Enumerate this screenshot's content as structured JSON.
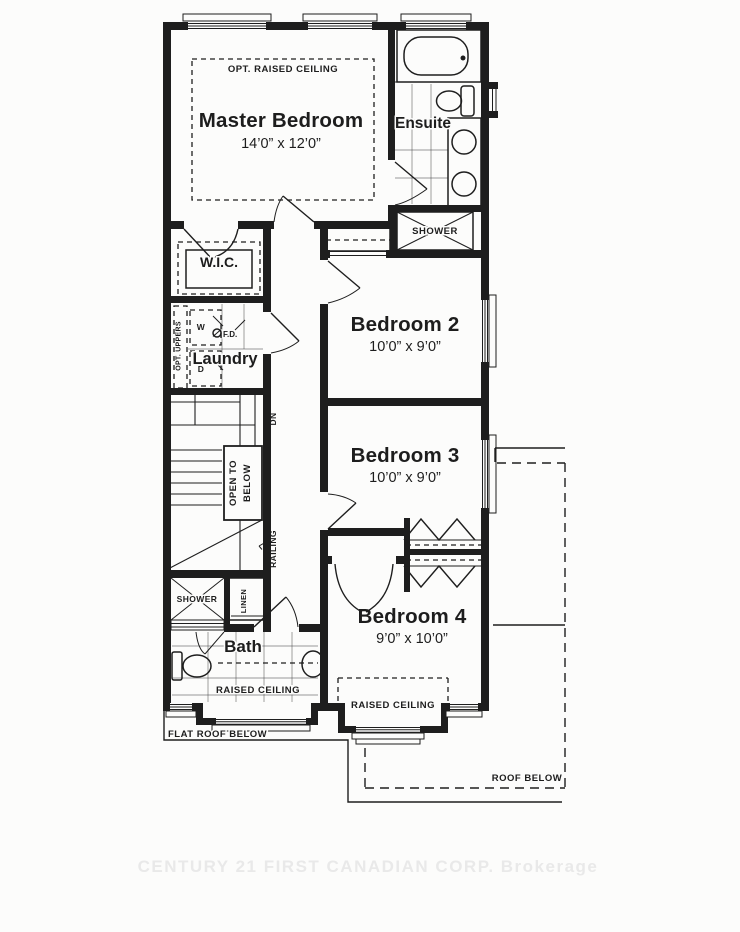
{
  "page": {
    "background": "#fcfcfb",
    "ink": "#1d1d1d",
    "watermark_color": "#e9e9e9"
  },
  "plan": {
    "master_bedroom": {
      "name": "Master Bedroom",
      "dims": "14’0” x 12’0”",
      "ceiling_note": "OPT. RAISED CEILING"
    },
    "ensuite": {
      "name": "Ensuite",
      "shower": "SHOWER"
    },
    "wic": {
      "name": "W.I.C."
    },
    "laundry": {
      "name": "Laundry",
      "washer": "W",
      "dryer": "D",
      "floor_drain": "F.D.",
      "uppers": "OPT. UPPERS"
    },
    "stairs": {
      "down": "DN",
      "open_to_below_1": "OPEN TO",
      "open_to_below_2": "BELOW",
      "railing": "RAILING"
    },
    "bedroom_2": {
      "name": "Bedroom 2",
      "dims": "10’0” x 9’0”"
    },
    "bedroom_3": {
      "name": "Bedroom 3",
      "dims": "10’0” x 9’0”"
    },
    "bedroom_4": {
      "name": "Bedroom 4",
      "dims": "9’0” x 10’0”",
      "raised_ceiling": "RAISED CEILING"
    },
    "bath": {
      "name": "Bath",
      "shower": "SHOWER",
      "linen": "LINEN",
      "raised_ceiling": "RAISED CEILING"
    },
    "notes": {
      "flat_roof": "FLAT ROOF BELOW",
      "roof": "ROOF BELOW"
    },
    "watermark": "CENTURY 21 FIRST CANADIAN CORP. Brokerage"
  }
}
